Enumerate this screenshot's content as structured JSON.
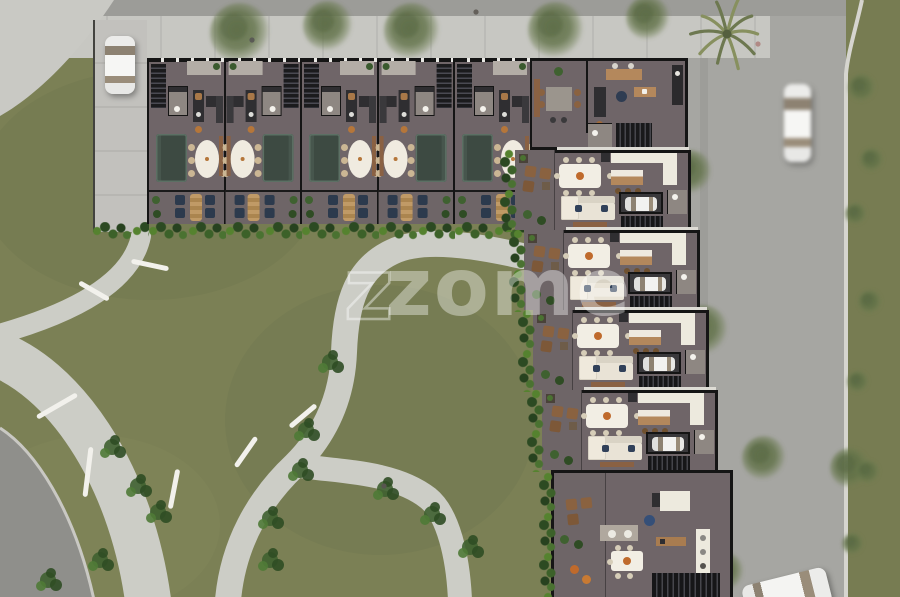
{
  "watermark": {
    "logo_prefix": "z",
    "text": "zome"
  },
  "palette": {
    "grass": "#7b8055",
    "grass_shade": "#6d744e",
    "grass_light": "#8a8e60",
    "park_path": "#cccdc6",
    "road": "#a6a6a2",
    "road_top": "#9c9c98",
    "road_dark": "#8f8f8b",
    "sidewalk": "#c7c7c2",
    "curb": "#d6d5cf",
    "wall": "#151515",
    "floor": "#6f6568",
    "terrace": "#6e6567",
    "porch": "#b3ada6",
    "sofa_green": "#3d4a42",
    "sofa_cream": "#e9e3d6",
    "table_white": "#f2eee4",
    "wood": "#b4885c",
    "navy_chair": "#2c3a4d",
    "brown_chair": "#8a6240",
    "hedge_dark": "#27421f",
    "hedge_mid": "#3c6129",
    "hedge_light": "#55822f",
    "accent_orange": "#bf6a2c",
    "car_white": "#f0f0ee",
    "tree_green": "#5f7046",
    "bench_white": "#f2f1ec"
  },
  "scene": {
    "cars": [
      {
        "id": "parked-car-driveway",
        "x": 105,
        "y": 36,
        "w": 30,
        "h": 58,
        "rot": 0,
        "style": "car-v",
        "blur": false
      },
      {
        "id": "moving-car-road",
        "x": 784,
        "y": 84,
        "w": 27,
        "h": 78,
        "rot": 0,
        "style": "car-v-long",
        "blur": true
      },
      {
        "id": "car-bottom-edge",
        "x": 744,
        "y": 576,
        "w": 86,
        "h": 38,
        "rot": -14,
        "style": "car-h",
        "blur": false
      }
    ],
    "pedestrians": [
      {
        "x": 252,
        "y": 40,
        "c": "#5a5a55"
      },
      {
        "x": 476,
        "y": 12,
        "c": "#64605a"
      },
      {
        "x": 758,
        "y": 44,
        "c": "#b08a85"
      },
      {
        "x": 384,
        "y": 486,
        "c": "#57554f"
      }
    ],
    "trees": [
      {
        "x": 240,
        "y": 33,
        "r": 30
      },
      {
        "x": 328,
        "y": 26,
        "r": 25
      },
      {
        "x": 412,
        "y": 31,
        "r": 28
      },
      {
        "x": 556,
        "y": 30,
        "r": 28
      },
      {
        "x": 648,
        "y": 18,
        "r": 22
      },
      {
        "x": 690,
        "y": 172,
        "r": 22
      },
      {
        "x": 703,
        "y": 330,
        "r": 25
      },
      {
        "x": 676,
        "y": 428,
        "r": 27
      },
      {
        "x": 764,
        "y": 458,
        "r": 22
      },
      {
        "x": 850,
        "y": 468,
        "r": 20
      },
      {
        "x": 697,
        "y": 512,
        "r": 24
      },
      {
        "x": 724,
        "y": 572,
        "r": 20
      },
      {
        "x": 646,
        "y": 574,
        "r": 18
      },
      {
        "x": 862,
        "y": 88,
        "r": 14
      },
      {
        "x": 872,
        "y": 160,
        "r": 12
      },
      {
        "x": 856,
        "y": 214,
        "r": 11
      },
      {
        "x": 870,
        "y": 302,
        "r": 12
      },
      {
        "x": 858,
        "y": 382,
        "r": 11
      },
      {
        "x": 868,
        "y": 472,
        "r": 12
      },
      {
        "x": 853,
        "y": 544,
        "r": 11
      }
    ],
    "palms": [
      {
        "x": 727,
        "y": 34,
        "r": 36
      }
    ],
    "benches": [
      {
        "x": 150,
        "y": 265,
        "len": 38,
        "rot": 12
      },
      {
        "x": 94,
        "y": 291,
        "len": 34,
        "rot": 30
      },
      {
        "x": 57,
        "y": 406,
        "len": 46,
        "rot": -30
      },
      {
        "x": 88,
        "y": 472,
        "len": 50,
        "rot": -83
      },
      {
        "x": 174,
        "y": 489,
        "len": 40,
        "rot": -79
      },
      {
        "x": 246,
        "y": 452,
        "len": 36,
        "rot": -55
      },
      {
        "x": 303,
        "y": 416,
        "len": 34,
        "rot": -40
      }
    ],
    "shrubs": [
      {
        "x": 112,
        "y": 447
      },
      {
        "x": 138,
        "y": 486
      },
      {
        "x": 158,
        "y": 512
      },
      {
        "x": 100,
        "y": 560
      },
      {
        "x": 48,
        "y": 580
      },
      {
        "x": 270,
        "y": 518
      },
      {
        "x": 306,
        "y": 430
      },
      {
        "x": 330,
        "y": 362
      },
      {
        "x": 385,
        "y": 489
      },
      {
        "x": 300,
        "y": 470
      },
      {
        "x": 432,
        "y": 514
      },
      {
        "x": 470,
        "y": 547
      },
      {
        "x": 270,
        "y": 560
      }
    ]
  },
  "building": {
    "driveway": {
      "x": 93,
      "y": 20,
      "w": 54,
      "h": 212
    },
    "driveway_hedge": {
      "x": 91,
      "y": 222,
      "w": 58
    },
    "top_row": {
      "y": 58,
      "units": [
        {
          "x": 147.0,
          "mirrored": false
        },
        {
          "x": 223.6,
          "mirrored": true
        },
        {
          "x": 300.2,
          "mirrored": false
        },
        {
          "x": 376.8,
          "mirrored": true
        },
        {
          "x": 453.4,
          "mirrored": false
        }
      ]
    },
    "corner_unit": {
      "x": 530,
      "y": 58,
      "w": 158,
      "h": 92
    },
    "right_units": [
      {
        "x": 515,
        "y": 150
      },
      {
        "x": 524,
        "y": 230
      },
      {
        "x": 533,
        "y": 310
      },
      {
        "x": 542,
        "y": 390
      }
    ],
    "bottom_unit": {
      "x": 551,
      "y": 470,
      "w": 182,
      "h": 127
    }
  }
}
